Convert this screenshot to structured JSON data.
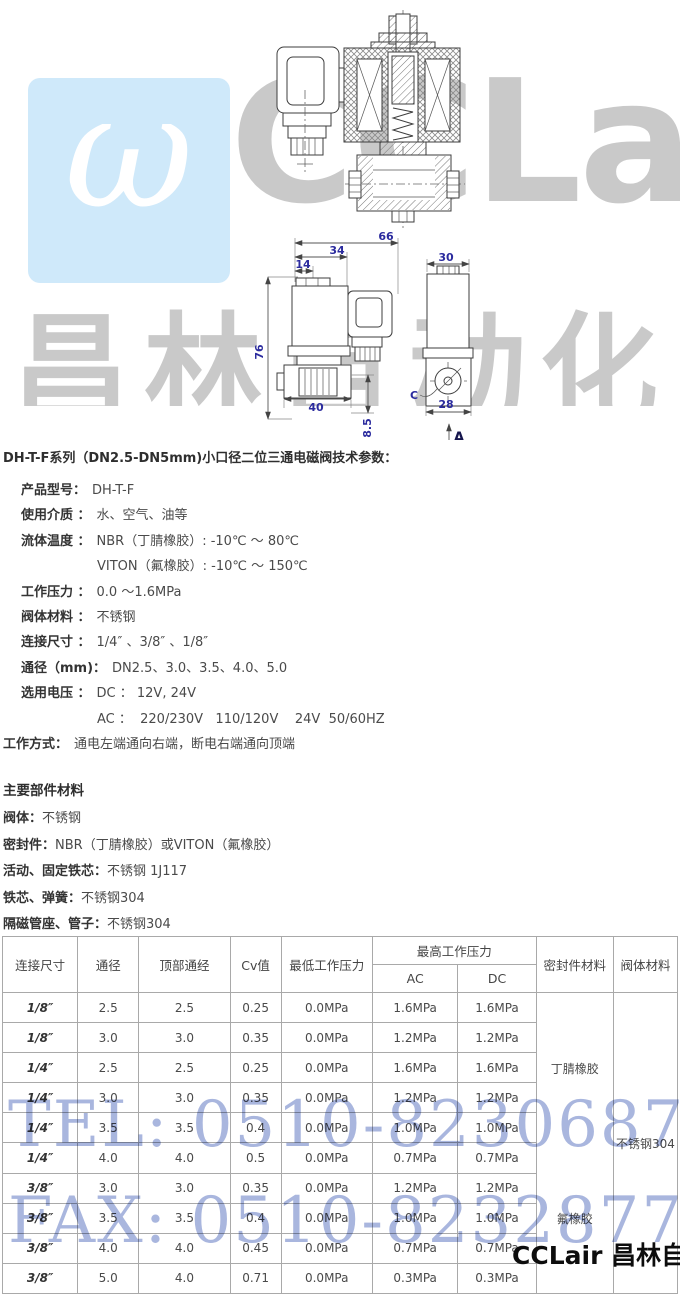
{
  "colors": {
    "dim_label": "#2b2b9e",
    "drawing_stroke": "#3d3d3d",
    "watermark_blue_bg": "#cfe9fa",
    "watermark_gray": "#c9c9c9",
    "telfax_blue": "#a9b6de",
    "table_border": "#a9a9a9",
    "text_dark": "#3c3c3c",
    "text_value": "#4a4a4a"
  },
  "watermark": {
    "logo_symbol": "ω",
    "logo_text": "CCLair",
    "brand_text": "昌林自动化",
    "tel": "TEL: 0510-82306871",
    "fax": "FAX: 0510-82328771",
    "footer_brand": "CCLair 昌林自动化"
  },
  "drawing": {
    "dims": {
      "total_width": "66",
      "coil_width": "34",
      "cap_offset": "14",
      "height": "76",
      "body_width": "40",
      "port_offset": "8.5",
      "side_width": "30",
      "side_body_width": "28",
      "port_label": "C",
      "section_arrow": "A"
    }
  },
  "specs": {
    "title": "DH-T-F系列（DN2.5-DN5mm)小口径二位三通电磁阀技术参数：",
    "rows": [
      {
        "label": "产品型号：",
        "value": "DH-T-F"
      },
      {
        "label": "使用介质 ：",
        "value": "水、空气、油等"
      },
      {
        "label": "流体温度 ：",
        "value": "NBR（丁腈橡胶）: -10℃ ～ 80℃"
      },
      {
        "label": "",
        "value": "VITON（氟橡胶）: -10℃ ～ 150℃",
        "indent": true
      },
      {
        "label": "工作压力 ：",
        "value": "0.0 ～1.6MPa"
      },
      {
        "label": "阀体材料 ：",
        "value": "不锈钢"
      },
      {
        "label": "连接尺寸 ：",
        "value": "1/4″ 、3/8″ 、1/8″"
      },
      {
        "label": "通径（mm)：",
        "value": "DN2.5、3.0、3.5、4.0、5.0"
      },
      {
        "label": "选用电压 ：",
        "value": "DC ： 12V, 24V"
      },
      {
        "label": "",
        "value": "AC ：  220/230V   110/120V    24V  50/60HZ",
        "indent": true
      },
      {
        "label": "工作方式：",
        "value": "通电左端通向右端，断电右端通向顶端",
        "flush": true
      }
    ]
  },
  "materials": {
    "title": "主要部件材料",
    "rows": [
      {
        "label": "阀体：",
        "value": "不锈钢"
      },
      {
        "label": "密封件：",
        "value": "NBR（丁腈橡胶）或VITON（氟橡胶）"
      },
      {
        "label": "活动、固定铁芯：",
        "value": "不锈钢 1J117"
      },
      {
        "label": "铁芯、弹簧：",
        "value": "不锈钢304"
      },
      {
        "label": "隔磁管座、管子：",
        "value": "不锈钢304"
      }
    ]
  },
  "table": {
    "headers": {
      "connection_size": "连接尺寸",
      "diameter": "通径",
      "top_diameter": "顶部通经",
      "cv": "Cv值",
      "min_pressure": "最低工作压力",
      "max_pressure": "最高工作压力",
      "ac": "AC",
      "dc": "DC",
      "seal_material": "密封件材料",
      "body_material": "阀体材料"
    },
    "rows": [
      [
        "1/8″",
        "2.5",
        "2.5",
        "0.25",
        "0.0MPa",
        "1.6MPa",
        "1.6MPa"
      ],
      [
        "1/8″",
        "3.0",
        "3.0",
        "0.35",
        "0.0MPa",
        "1.2MPa",
        "1.2MPa"
      ],
      [
        "1/4″",
        "2.5",
        "2.5",
        "0.25",
        "0.0MPa",
        "1.6MPa",
        "1.6MPa"
      ],
      [
        "1/4″",
        "3.0",
        "3.0",
        "0.35",
        "0.0MPa",
        "1.2MPa",
        "1.2MPa"
      ],
      [
        "1/4″",
        "3.5",
        "3.5",
        "0.4",
        "0.0MPa",
        "1.0MPa",
        "1.0MPa"
      ],
      [
        "1/4″",
        "4.0",
        "4.0",
        "0.5",
        "0.0MPa",
        "0.7MPa",
        "0.7MPa"
      ],
      [
        "3/8″",
        "3.0",
        "3.0",
        "0.35",
        "0.0MPa",
        "1.2MPa",
        "1.2MPa"
      ],
      [
        "3/8″",
        "3.5",
        "3.5",
        "0.4",
        "0.0MPa",
        "1.0MPa",
        "1.0MPa"
      ],
      [
        "3/8″",
        "4.0",
        "4.0",
        "0.45",
        "0.0MPa",
        "0.7MPa",
        "0.7MPa"
      ],
      [
        "3/8″",
        "5.0",
        "4.0",
        "0.71",
        "0.0MPa",
        "0.3MPa",
        "0.3MPa"
      ]
    ],
    "seal_materials": [
      "丁腈橡胶",
      "氟橡胶"
    ],
    "body_material": "不锈钢304"
  }
}
